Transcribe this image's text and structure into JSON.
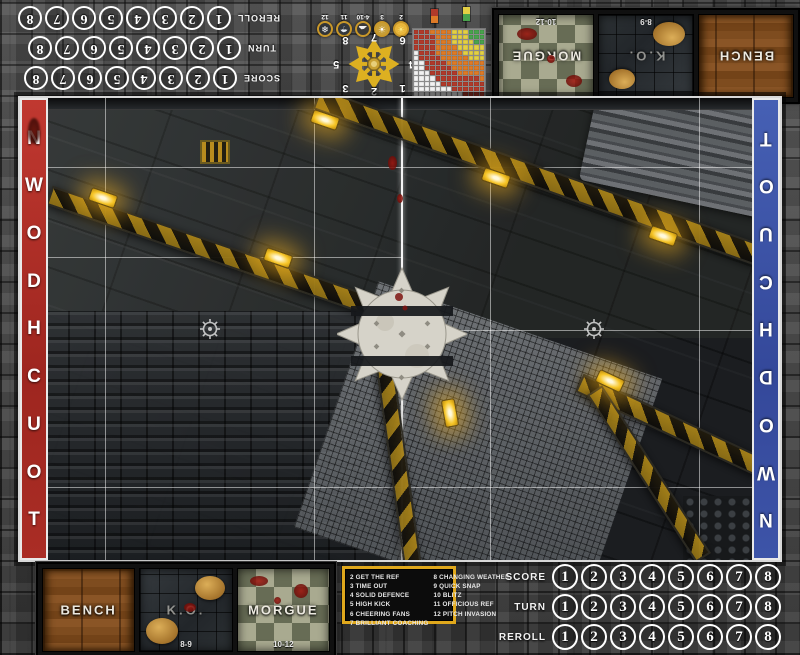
{
  "colors": {
    "accent-red": "#b23028",
    "accent-blue": "#3d56a6",
    "hazard-yellow": "#d9a31d",
    "circle-white": "#ffffff",
    "kickoff-border": "#e0a81c",
    "check-light": "#a9aa90",
    "check-dark": "#676c55"
  },
  "tracks": {
    "numbers": [
      "1",
      "2",
      "3",
      "4",
      "5",
      "6",
      "7",
      "8"
    ],
    "rows": [
      {
        "label": "SCORE"
      },
      {
        "label": "TURN"
      },
      {
        "label": "REROLL"
      }
    ]
  },
  "dugout": {
    "sections": [
      {
        "label": "BENCH",
        "range": ""
      },
      {
        "label": "K.O.",
        "range": "8-9"
      },
      {
        "label": "MORGUE",
        "range": "10-12"
      }
    ]
  },
  "pitch": {
    "touchdown_text": "TOUCHDOWN",
    "touchdown_letters": [
      "T",
      "O",
      "U",
      "C",
      "H",
      "D",
      "O",
      "W",
      "N"
    ]
  },
  "weather": {
    "items": [
      {
        "range": "2",
        "icon": "sun-icon",
        "glyph": "☀",
        "fill": "#e8b63b",
        "glyph_color": "#f9e77f"
      },
      {
        "range": "3",
        "icon": "sunny-icon",
        "glyph": "☀",
        "fill": "#c79f38",
        "glyph_color": "#ffffff"
      },
      {
        "range": "4-10",
        "icon": "cloud-icon",
        "glyph": "☁",
        "fill": "#3a3a3a",
        "glyph_color": "#f2f2f2"
      },
      {
        "range": "11",
        "icon": "rain-icon",
        "glyph": "☂",
        "fill": "#34383c",
        "glyph_color": "#e8eef4"
      },
      {
        "range": "12",
        "icon": "snow-icon",
        "glyph": "❄",
        "fill": "#303438",
        "glyph_color": "#ffffff"
      }
    ]
  },
  "scatter": {
    "numbers": [
      "1",
      "2",
      "3",
      "4",
      "5",
      "6",
      "7",
      "8"
    ]
  },
  "range_chart": {
    "rows": [
      "RRROOOOYYYGGG",
      "RRRROOOYYYGGG",
      "RRRROOOYYYYGG",
      "RRRROOOOYYYYY",
      "WRRROOOOOYYYY",
      "WRRRROOOOOYYY",
      "WWRRRROOOOOOO",
      "WWRRRRROOOOOO",
      "WWWRRRRROOOOO",
      "WWWWRRRRRRRRO",
      "WWWWWRRRRRRRR",
      "WWWWWWWRRRRRR",
      "WWWWWWWWWRRRR"
    ],
    "colors": {
      "W": "#f2f2f2",
      "R": "#b03a2a",
      "O": "#dd7a27",
      "Y": "#e3cf44",
      "G": "#49a34d"
    },
    "legend": [
      [
        "#b03a2a",
        "#dd7a27"
      ],
      [
        "#e3cf44",
        "#49a34d"
      ]
    ]
  },
  "kickoff": {
    "left": [
      "2 GET THE REF",
      "3 TIME OUT",
      "4 SOLID DEFENCE",
      "5 HIGH KICK",
      "6 CHEERING FANS",
      "7 BRILLIANT COACHING"
    ],
    "right": [
      "8 CHANGING WEATHER",
      "9 QUICK SNAP",
      "10 BLITZ",
      "11 OFFICIOUS REF",
      "12 PITCH INVASION"
    ]
  }
}
